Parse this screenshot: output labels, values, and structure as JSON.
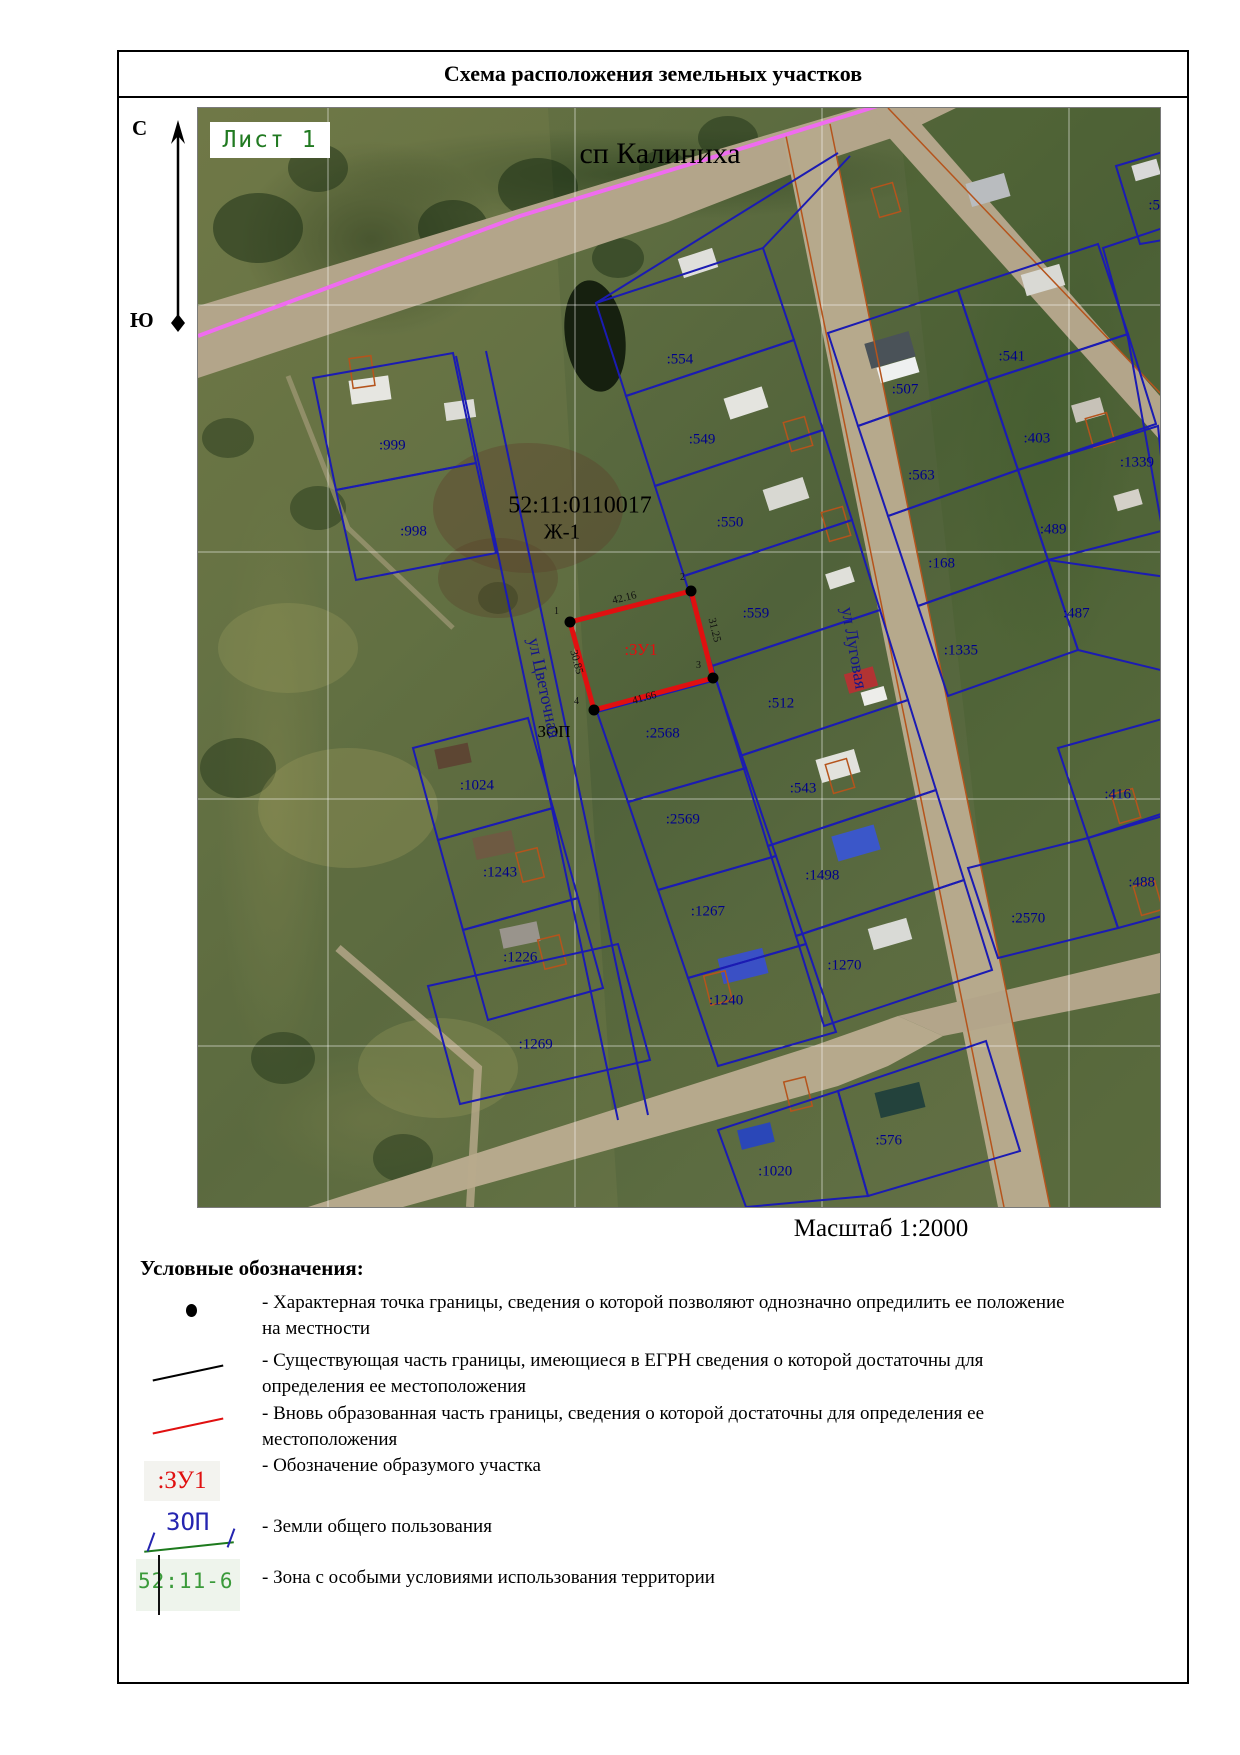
{
  "title": "Схема расположения земельных участков",
  "sheet_label": "Лист 1",
  "compass": {
    "north": "С",
    "south": "Ю"
  },
  "scale_label": "Масштаб 1:2000",
  "map": {
    "settlement_label": "сп Калиниха",
    "quarter_number": "52:11:0110017",
    "zone_label": "Ж-1",
    "zop_label": "ЗОП",
    "street_tsvetochnaya": "ул Цветочная",
    "street_lugovaya": "ул Луговая",
    "new_parcel": {
      "label": ":ЗУ1",
      "dim_top": "42.16",
      "dim_right": "31.25",
      "dim_bottom": "41.66",
      "dim_left": "30.85",
      "p1": "1",
      "p2": "2",
      "p3": "3",
      "p4": "4"
    },
    "parcels": [
      {
        "label": ":554",
        "x": 50.1,
        "y": 22.9
      },
      {
        "label": ":549",
        "x": 52.4,
        "y": 30.2
      },
      {
        "label": ":550",
        "x": 55.3,
        "y": 37.8
      },
      {
        "label": ":559",
        "x": 58.0,
        "y": 46.0
      },
      {
        "label": ":999",
        "x": 20.2,
        "y": 30.8
      },
      {
        "label": ":998",
        "x": 22.4,
        "y": 38.6
      },
      {
        "label": ":507",
        "x": 73.5,
        "y": 25.7
      },
      {
        "label": ":541",
        "x": 84.6,
        "y": 22.7
      },
      {
        "label": ":403",
        "x": 87.2,
        "y": 30.1
      },
      {
        "label": ":1339",
        "x": 97.6,
        "y": 32.3
      },
      {
        "label": ":489",
        "x": 88.9,
        "y": 38.4
      },
      {
        "label": ":563",
        "x": 75.2,
        "y": 33.5
      },
      {
        "label": ":168",
        "x": 77.3,
        "y": 41.5
      },
      {
        "label": ":487",
        "x": 91.3,
        "y": 46.0
      },
      {
        "label": ":1335",
        "x": 79.3,
        "y": 49.4
      },
      {
        "label": ":512",
        "x": 60.6,
        "y": 54.2
      },
      {
        "label": ":2568",
        "x": 48.3,
        "y": 57.0
      },
      {
        "label": ":543",
        "x": 62.9,
        "y": 62.0
      },
      {
        "label": ":2569",
        "x": 50.4,
        "y": 64.8
      },
      {
        "label": ":1498",
        "x": 64.9,
        "y": 69.9
      },
      {
        "label": ":1267",
        "x": 53.0,
        "y": 73.2
      },
      {
        "label": ":1270",
        "x": 67.2,
        "y": 78.1
      },
      {
        "label": ":1240",
        "x": 54.9,
        "y": 81.3
      },
      {
        "label": ":1269",
        "x": 35.1,
        "y": 85.3
      },
      {
        "label": ":1024",
        "x": 29.0,
        "y": 61.7
      },
      {
        "label": ":1243",
        "x": 31.4,
        "y": 69.6
      },
      {
        "label": ":1226",
        "x": 33.5,
        "y": 77.3
      },
      {
        "label": ":416",
        "x": 95.6,
        "y": 62.5
      },
      {
        "label": ":488",
        "x": 98.1,
        "y": 70.5
      },
      {
        "label": ":2570",
        "x": 86.3,
        "y": 73.8
      },
      {
        "label": ":576",
        "x": 71.8,
        "y": 94.0
      },
      {
        "label": ":1020",
        "x": 60.0,
        "y": 96.8
      },
      {
        "label": ":5",
        "x": 99.4,
        "y": 8.9
      }
    ]
  },
  "legend": {
    "heading": "Условные обозначения:",
    "items": [
      {
        "symbol": "point",
        "text": "- Характерная точка границы, сведения о которой позволяют однозначно опредилить ее положение\nна местности"
      },
      {
        "symbol": "black-line",
        "text": "- Существующая часть границы, имеющиеся в ЕГРН сведения о которой достаточны для\nопределения ее местоположения"
      },
      {
        "symbol": "red-line",
        "text": "- Вновь образованная часть границы, сведения о которой достаточны для определения ее\nместоположения"
      },
      {
        "symbol": "zu1",
        "symbol_label": ":ЗУ1",
        "text": "- Обозначение образумого участка"
      },
      {
        "symbol": "zop",
        "symbol_label": "ЗОП",
        "text": "- Земли общего пользования"
      },
      {
        "symbol": "zone",
        "symbol_label": "52:11-6",
        "text": "- Зона с особыми условиями использования территории"
      }
    ]
  },
  "colors": {
    "new_boundary_red": "#e01010",
    "cadastral_blue": "#1b1bb3",
    "zone_pink": "#ef6cf0",
    "sheet_green": "#217a21",
    "building_orange": "#b5541c"
  }
}
